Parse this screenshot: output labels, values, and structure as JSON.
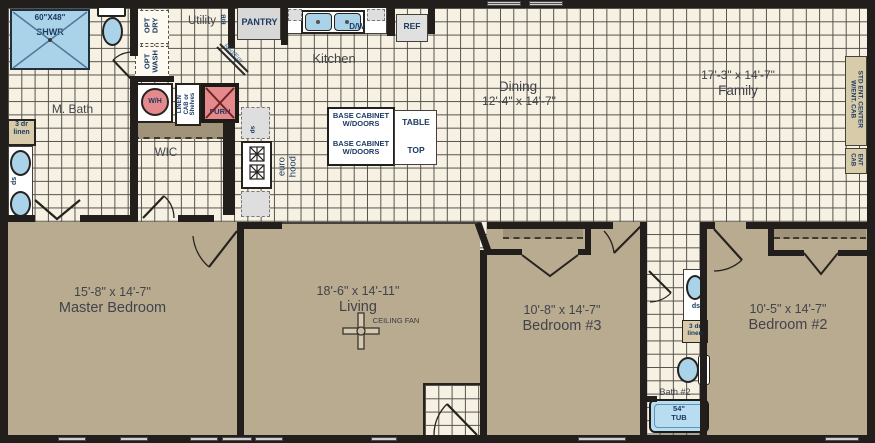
{
  "rooms": {
    "mbath": "M. Bath",
    "utility": "Utility",
    "kitchen": "Kitchen",
    "wic": "WIC",
    "dining": "Dining",
    "dining_dims": "12'-4\" x 14'-7\"",
    "family": "Family",
    "family_dims": "17'-3\" x 14'-7\"",
    "master": "Master Bedroom",
    "master_dims": "15'-8\" x 14'-7\"",
    "living": "Living",
    "living_dims": "18'-6\" x 14'-11\"",
    "bedroom3": "Bedroom #3",
    "bedroom3_dims": "10'-8\" x 14'-7\"",
    "bedroom2": "Bedroom #2",
    "bedroom2_dims": "10'-5\" x 14'-7\"",
    "bath2": "Bath #2"
  },
  "fx": {
    "shower_size": "60\"X48\"",
    "shower_label": "SHWR",
    "linen_line1": "3 dr",
    "linen_line2": "linen",
    "ds": "ds",
    "opt": "OPT",
    "dry": "DRY",
    "wash": "WASH",
    "bb": "B/B",
    "reg_egr": "Reg/Egr",
    "wh": "W/H",
    "linen_cab_1": "LINEN",
    "linen_cab_2": "CAB or",
    "linen_cab_3": "Shelves",
    "furn": "FURN",
    "pantry": "PANTRY",
    "dw": "D/W",
    "ref": "REF",
    "base1": "BASE CABINET",
    "base2": "W/DOORS",
    "table": "TABLE",
    "top": "TOP",
    "euro_1": "euro",
    "euro_2": "hood",
    "entc1": "STD ENT. CENTER",
    "entc2": "W/ENT. CAB",
    "entcab1": "ENT",
    "entcab2": "CAB",
    "ceiling_fan": "CEILING FAN",
    "tub_size": "54\"",
    "tub_label": "TUB"
  },
  "colors": {
    "wall": "#211e1b",
    "tile": "#f6f1e2",
    "grid_line": "#55524c",
    "carpet": "#b9ab90",
    "closet_shelf": "#a1937a",
    "fixture_blue": "#aad2e8",
    "fixture_red": "#e5898d",
    "appliance_gray": "#d8d8d8",
    "label_navy": "#1c3a60",
    "label_dark": "#42434a"
  }
}
